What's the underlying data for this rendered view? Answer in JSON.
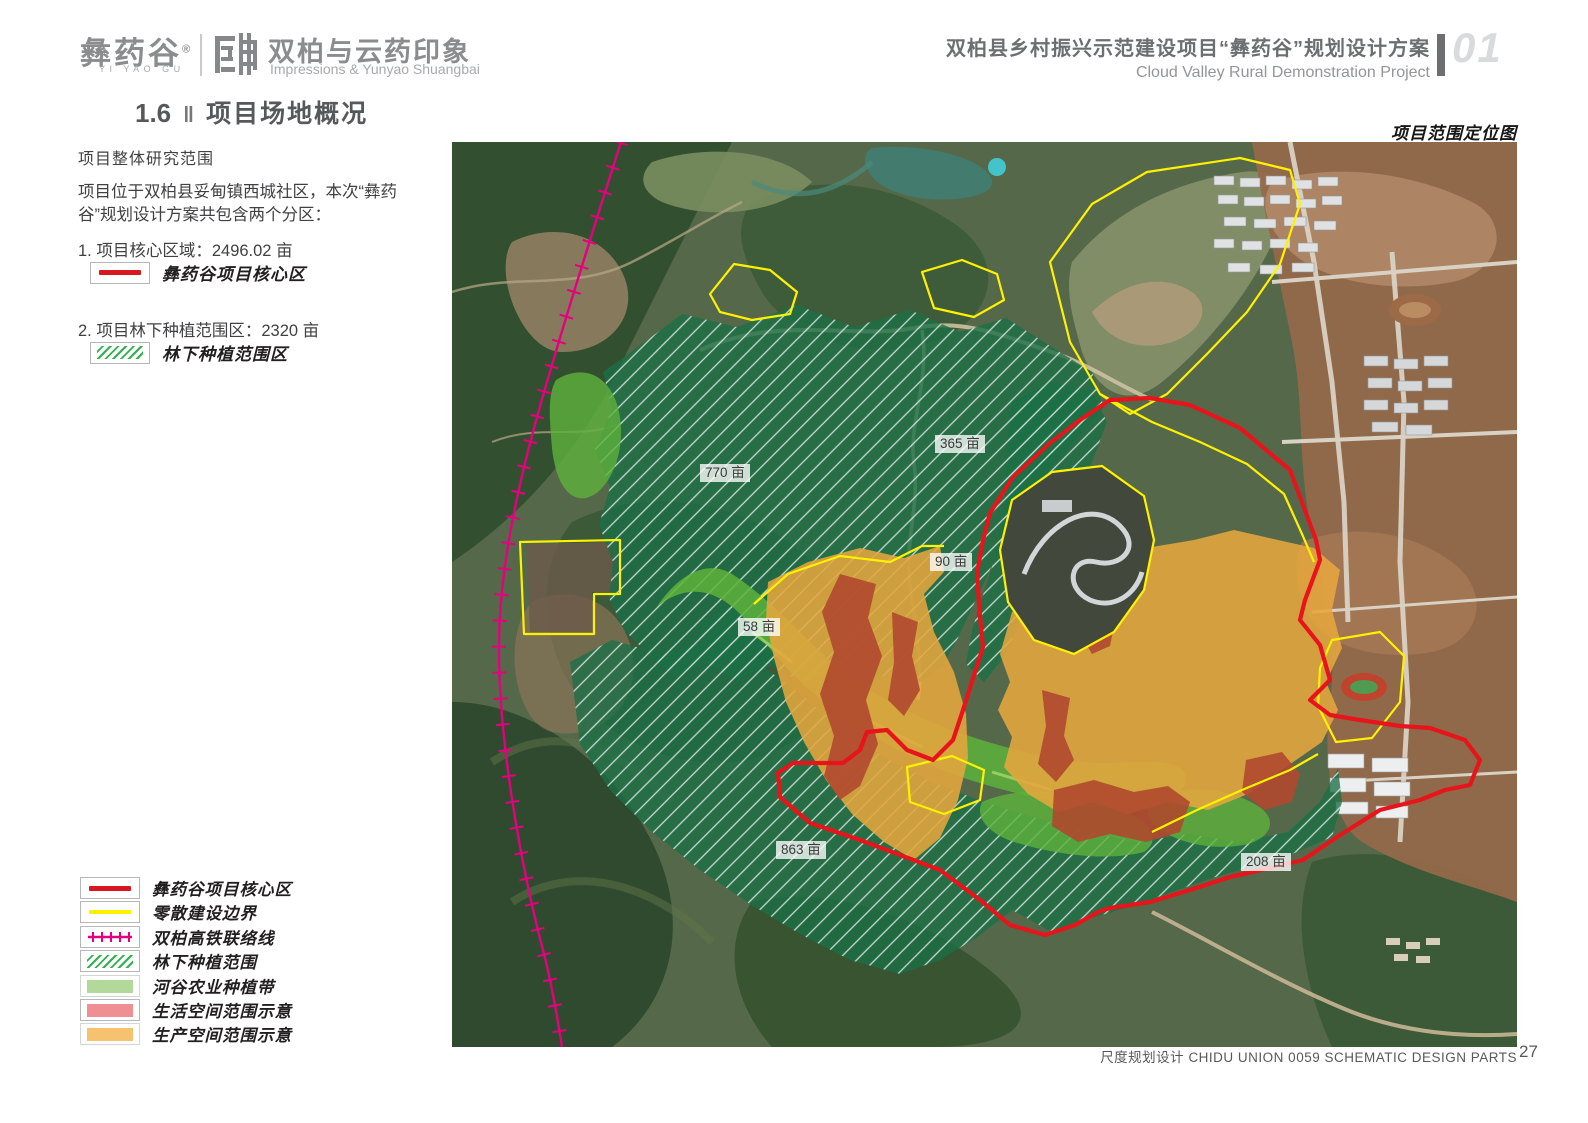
{
  "header": {
    "logo": {
      "brand_cn": "彝药谷",
      "brand_reg": "®",
      "brand_en": "YI YAO GU",
      "partner_cn": "双柏与云药印象",
      "partner_en": "Impressions & Yunyao Shuangbai"
    },
    "project_title_cn": "双柏县乡村振兴示范建设项目“彝药谷”规划设计方案",
    "project_title_en": "Cloud Valley Rural Demonstration Project",
    "chapter_number": "01"
  },
  "section": {
    "number": "1.6",
    "separator": "‖",
    "title": "项目场地概况"
  },
  "intro": {
    "subtitle": "项目整体研究范围",
    "paragraph": "项目位于双柏县妥甸镇西城社区，本次“彝药谷”规划设计方案共包含两个分区：",
    "items": [
      {
        "text": "1. 项目核心区域：2496.02 亩",
        "legend_label": "彝药谷项目核心区",
        "swatch": "red-line"
      },
      {
        "text": "2. 项目林下种植范围区：2320 亩",
        "legend_label": "林下种植范围区",
        "swatch": "green-hatch"
      }
    ]
  },
  "map": {
    "title": "项目范围定位图",
    "area_labels": [
      {
        "text": "770 亩"
      },
      {
        "text": "365 亩"
      },
      {
        "text": "90 亩"
      },
      {
        "text": "58 亩"
      },
      {
        "text": "863 亩"
      },
      {
        "text": "208 亩"
      }
    ],
    "overlay_colors": {
      "core_boundary_red": "#e8141b",
      "scattered_boundary_yellow": "#fff100",
      "railway_magenta": "#e5007f",
      "understory_hatch_green": "#1b7046",
      "valley_farm_green": "#5eb13c",
      "production_orange": "#e6a63e",
      "living_red": "#b0492f"
    }
  },
  "legend": {
    "items": [
      {
        "label": "彝药谷项目核心区",
        "type": "red-line",
        "color": "#d7191f"
      },
      {
        "label": "零散建设边界",
        "type": "yellow-line",
        "color": "#fff100"
      },
      {
        "label": "双柏高铁联络线",
        "type": "railway-line",
        "color": "#e5007f"
      },
      {
        "label": "林下种植范围",
        "type": "green-hatch",
        "color": "#2eb24c"
      },
      {
        "label": "河谷农业种植带",
        "type": "fill",
        "color": "#b2d89a"
      },
      {
        "label": "生活空间范围示意",
        "type": "fill",
        "color": "#ef8f93"
      },
      {
        "label": "生产空间范围示意",
        "type": "fill",
        "color": "#f6c26f"
      }
    ]
  },
  "footer": {
    "credit": "尺度规划设计 CHIDU UNION 0059 SCHEMATIC DESIGN PARTS",
    "page_number": "27"
  }
}
